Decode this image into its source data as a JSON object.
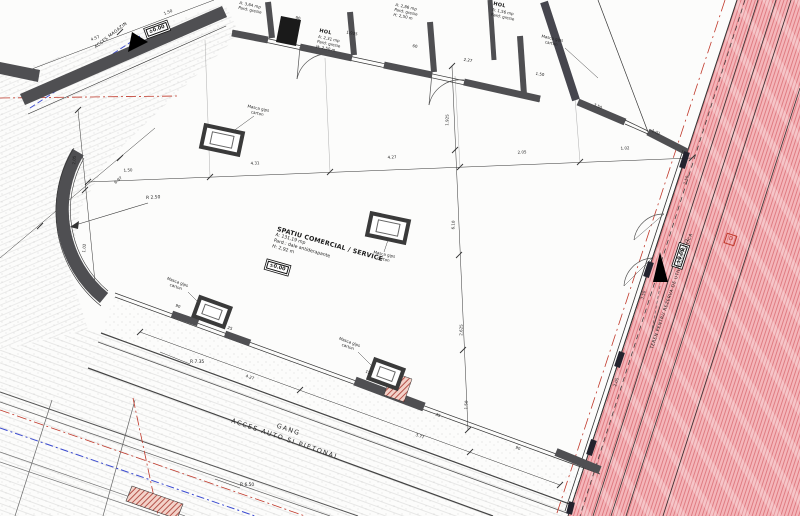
{
  "drawing": {
    "main_room": {
      "name": "SPATIU COMERCIAL / SERVICE",
      "area": "A: 131,19 mp",
      "floor": "Pard.: dale antiderapante",
      "height": "H: 2,92 m",
      "level": "±0.00"
    },
    "rooms": [
      {
        "name": "HOL",
        "area": "A: 2,31 mp",
        "floor": "Pard: gresie",
        "height": "H: 2,50 m"
      },
      {
        "name": "",
        "area": "A: 2,86 mp",
        "floor": "Pard: gresie",
        "height": "H: 2,50 m"
      },
      {
        "name": "HOL",
        "area": "A: 1,56 mp",
        "floor": "Pard: gresie",
        "height": "H: 2,50 m"
      },
      {
        "name": "",
        "area": "A: 3,64 mp",
        "floor": "Pard: gresie",
        "height": ""
      }
    ],
    "masca_label": "Masca gips carton",
    "gang": {
      "line1": "GANG",
      "line2": "ACCES AUTO SI PIETONAL"
    },
    "red_zone": {
      "label": "TEREN PENTRU REZERVA DE UTILITATE PUBLICA",
      "marker": "D"
    },
    "access": [
      {
        "label": "ACCES MAGAZIN",
        "level": "±0.00"
      },
      {
        "label": "ACCES AUTO",
        "level": "±0.00"
      }
    ],
    "radii": [
      "R 2.50",
      "R 7.35",
      "R 6.50"
    ],
    "dimensions": [
      {
        "t": "1.50",
        "x": 128,
        "y": 170,
        "r": -3
      },
      {
        "t": "4.31",
        "x": 255,
        "y": 163,
        "r": -3
      },
      {
        "t": "4.27",
        "x": 392,
        "y": 157,
        "r": -3
      },
      {
        "t": "2.05",
        "x": 522,
        "y": 152,
        "r": -3
      },
      {
        "t": "1.02",
        "x": 625,
        "y": 148,
        "r": -3
      },
      {
        "t": "1.925",
        "x": 447,
        "y": 120,
        "r": -88
      },
      {
        "t": "6.10",
        "x": 453,
        "y": 225,
        "r": -88
      },
      {
        "t": "2.625",
        "x": 461,
        "y": 330,
        "r": -88
      },
      {
        "t": "1.50",
        "x": 466,
        "y": 405,
        "r": -88
      },
      {
        "t": "4.27",
        "x": 250,
        "y": 377,
        "r": 20
      },
      {
        "t": "3.77",
        "x": 420,
        "y": 436,
        "r": 20
      },
      {
        "t": "2.05",
        "x": 74,
        "y": 160,
        "r": -85
      },
      {
        "t": "1.02",
        "x": 84,
        "y": 248,
        "r": -85
      },
      {
        "t": "4.57",
        "x": 95,
        "y": 38,
        "r": -22
      },
      {
        "t": "1.50",
        "x": 168,
        "y": 12,
        "r": -22
      },
      {
        "t": "6.97",
        "x": 118,
        "y": 180,
        "r": -40
      },
      {
        "t": "90",
        "x": 298,
        "y": 18,
        "r": 10
      },
      {
        "t": "1.925",
        "x": 352,
        "y": 33,
        "r": 10
      },
      {
        "t": "60",
        "x": 415,
        "y": 46,
        "r": 10
      },
      {
        "t": "2.27",
        "x": 468,
        "y": 60,
        "r": 10
      },
      {
        "t": "1.50",
        "x": 540,
        "y": 74,
        "r": 10
      },
      {
        "t": "3.50",
        "x": 598,
        "y": 106,
        "r": 23
      },
      {
        "t": "1.02",
        "x": 656,
        "y": 132,
        "r": 23
      },
      {
        "t": "90",
        "x": 178,
        "y": 306,
        "r": 20
      },
      {
        "t": "25",
        "x": 230,
        "y": 328,
        "r": 20
      },
      {
        "t": "15",
        "x": 368,
        "y": 372,
        "r": 20
      },
      {
        "t": "35",
        "x": 438,
        "y": 415,
        "r": 20
      },
      {
        "t": "90",
        "x": 518,
        "y": 448,
        "r": 20
      },
      {
        "t": "1.50",
        "x": 686,
        "y": 180,
        "r": -72
      },
      {
        "t": "3.50",
        "x": 643,
        "y": 295,
        "r": -72
      },
      {
        "t": "2.05",
        "x": 616,
        "y": 382,
        "r": -72
      }
    ]
  }
}
